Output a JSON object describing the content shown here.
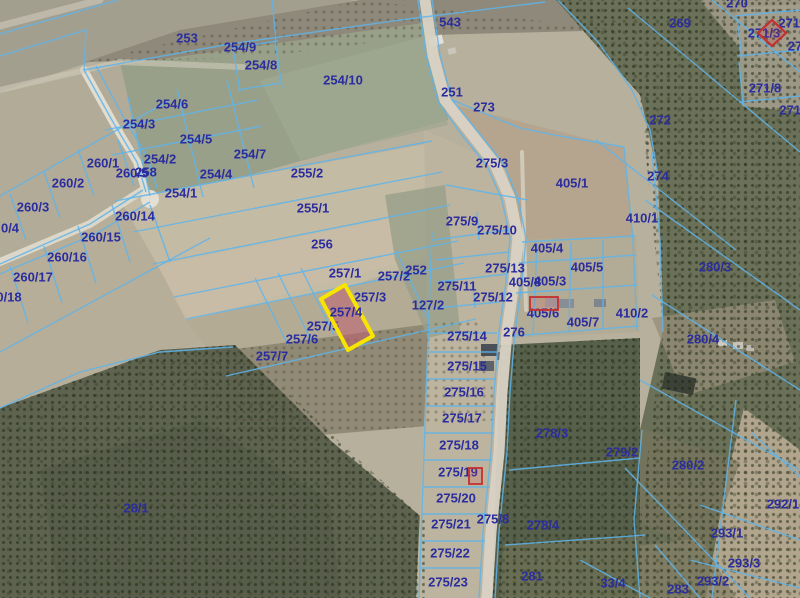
{
  "map": {
    "colors": {
      "boundary_line": "#5fb4ea",
      "label_text": "#2b2d9e",
      "highlight_stroke": "#f7e400",
      "highlight_fill": "rgba(190,95,110,0.55)",
      "marker_red": "#c43030",
      "road_light": "#d9d3c5"
    },
    "highlight": {
      "parcel": "257/4",
      "points": "321,299 345,285 373,336 348,350",
      "stroke_width": 4
    },
    "markers": [
      {
        "type": "diamond",
        "points": "772,20 786,33 772,46 758,33"
      },
      {
        "type": "rect",
        "x": 530,
        "y": 297,
        "w": 28,
        "h": 13
      },
      {
        "type": "rect",
        "x": 469,
        "y": 468,
        "w": 13,
        "h": 16
      }
    ],
    "labels": [
      {
        "t": "253",
        "x": 187,
        "y": 38
      },
      {
        "t": "254/9",
        "x": 240,
        "y": 47
      },
      {
        "t": "254/8",
        "x": 261,
        "y": 65
      },
      {
        "t": "254/10",
        "x": 343,
        "y": 80
      },
      {
        "t": "543",
        "x": 450,
        "y": 22
      },
      {
        "t": "251",
        "x": 452,
        "y": 92
      },
      {
        "t": "273",
        "x": 484,
        "y": 107
      },
      {
        "t": "270",
        "x": 737,
        "y": 3
      },
      {
        "t": "269",
        "x": 680,
        "y": 23
      },
      {
        "t": "271/",
        "x": 791,
        "y": 23
      },
      {
        "t": "271/3",
        "x": 764,
        "y": 33
      },
      {
        "t": "27",
        "x": 795,
        "y": 46
      },
      {
        "t": "271/8",
        "x": 765,
        "y": 88
      },
      {
        "t": "271/",
        "x": 792,
        "y": 110
      },
      {
        "t": "272",
        "x": 660,
        "y": 120
      },
      {
        "t": "274",
        "x": 658,
        "y": 176
      },
      {
        "t": "254/6",
        "x": 172,
        "y": 104
      },
      {
        "t": "254/3",
        "x": 139,
        "y": 124
      },
      {
        "t": "254/5",
        "x": 196,
        "y": 139
      },
      {
        "t": "254/7",
        "x": 250,
        "y": 154
      },
      {
        "t": "254/2",
        "x": 160,
        "y": 159
      },
      {
        "t": "260/1",
        "x": 103,
        "y": 163
      },
      {
        "t": "260/5",
        "x": 132,
        "y": 173
      },
      {
        "t": "258",
        "x": 146,
        "y": 172
      },
      {
        "t": "254/4",
        "x": 216,
        "y": 174
      },
      {
        "t": "255/2",
        "x": 307,
        "y": 173
      },
      {
        "t": "254/1",
        "x": 181,
        "y": 193
      },
      {
        "t": "260/2",
        "x": 68,
        "y": 183
      },
      {
        "t": "260/3",
        "x": 33,
        "y": 207
      },
      {
        "t": "0/4",
        "x": 10,
        "y": 228
      },
      {
        "t": "260/14",
        "x": 135,
        "y": 216
      },
      {
        "t": "260/15",
        "x": 101,
        "y": 237
      },
      {
        "t": "260/16",
        "x": 67,
        "y": 257
      },
      {
        "t": "260/17",
        "x": 33,
        "y": 277
      },
      {
        "t": "0/18",
        "x": 9,
        "y": 297
      },
      {
        "t": "275/3",
        "x": 492,
        "y": 163
      },
      {
        "t": "405/1",
        "x": 572,
        "y": 183
      },
      {
        "t": "410/1",
        "x": 642,
        "y": 218
      },
      {
        "t": "275/9",
        "x": 462,
        "y": 221
      },
      {
        "t": "275/10",
        "x": 497,
        "y": 230
      },
      {
        "t": "405/4",
        "x": 547,
        "y": 248
      },
      {
        "t": "255/1",
        "x": 313,
        "y": 208
      },
      {
        "t": "256",
        "x": 322,
        "y": 244
      },
      {
        "t": "252",
        "x": 416,
        "y": 270
      },
      {
        "t": "257/1",
        "x": 345,
        "y": 273
      },
      {
        "t": "257/2",
        "x": 394,
        "y": 276
      },
      {
        "t": "275/13",
        "x": 505,
        "y": 268
      },
      {
        "t": "405/5",
        "x": 587,
        "y": 267
      },
      {
        "t": "275/11",
        "x": 457,
        "y": 286
      },
      {
        "t": "405/8",
        "x": 525,
        "y": 282
      },
      {
        "t": "405/3",
        "x": 550,
        "y": 281
      },
      {
        "t": "257/3",
        "x": 370,
        "y": 297
      },
      {
        "t": "275/12",
        "x": 493,
        "y": 297
      },
      {
        "t": "127/2",
        "x": 428,
        "y": 305
      },
      {
        "t": "257/4",
        "x": 346,
        "y": 312,
        "top": true
      },
      {
        "t": "405/6",
        "x": 543,
        "y": 313
      },
      {
        "t": "405/7",
        "x": 583,
        "y": 322
      },
      {
        "t": "410/2",
        "x": 632,
        "y": 313
      },
      {
        "t": "280/3",
        "x": 715,
        "y": 267
      },
      {
        "t": "257/5",
        "x": 323,
        "y": 326
      },
      {
        "t": "276",
        "x": 514,
        "y": 332
      },
      {
        "t": "275/14",
        "x": 467,
        "y": 336
      },
      {
        "t": "257/6",
        "x": 302,
        "y": 339
      },
      {
        "t": "280/4",
        "x": 703,
        "y": 339
      },
      {
        "t": "257/7",
        "x": 272,
        "y": 356
      },
      {
        "t": "275/15",
        "x": 467,
        "y": 366
      },
      {
        "t": "275/16",
        "x": 464,
        "y": 392
      },
      {
        "t": "275/17",
        "x": 462,
        "y": 418
      },
      {
        "t": "278/3",
        "x": 552,
        "y": 433
      },
      {
        "t": "275/18",
        "x": 459,
        "y": 445
      },
      {
        "t": "279/2",
        "x": 622,
        "y": 452
      },
      {
        "t": "280/2",
        "x": 688,
        "y": 465
      },
      {
        "t": "275/19",
        "x": 458,
        "y": 472
      },
      {
        "t": "275/20",
        "x": 456,
        "y": 498
      },
      {
        "t": "28/1",
        "x": 136,
        "y": 508
      },
      {
        "t": "292/1",
        "x": 783,
        "y": 504
      },
      {
        "t": "275/21",
        "x": 451,
        "y": 524
      },
      {
        "t": "275/8",
        "x": 493,
        "y": 519
      },
      {
        "t": "278/4",
        "x": 543,
        "y": 525
      },
      {
        "t": "293/1",
        "x": 727,
        "y": 533
      },
      {
        "t": "275/22",
        "x": 450,
        "y": 553
      },
      {
        "t": "293/3",
        "x": 744,
        "y": 563
      },
      {
        "t": "281",
        "x": 532,
        "y": 576
      },
      {
        "t": "275/23",
        "x": 448,
        "y": 582
      },
      {
        "t": "33/4",
        "x": 613,
        "y": 583
      },
      {
        "t": "283",
        "x": 678,
        "y": 589
      },
      {
        "t": "293/2",
        "x": 713,
        "y": 581
      }
    ],
    "roads": [
      {
        "d": "M425,0 L433,55 L445,100 L470,132 L495,164 L510,198 L518,238 L514,282 L507,332 L502,392 L499,452 L491,532 L487,598",
        "w": 11,
        "c": "#d9d3c5",
        "o": 0.95
      },
      {
        "d": "M84,70 L113,122 L137,162 L146,192",
        "w": 8,
        "c": "#e4dfd3",
        "o": 0.95
      },
      {
        "d": "M143,190 L90,224 L0,262",
        "w": 8,
        "c": "#e0dbcd",
        "o": 0.9
      },
      {
        "d": "M0,90 L120,62 L243,67",
        "w": 6,
        "c": "#cfc9ba",
        "o": 0.6
      },
      {
        "d": "M0,26 L100,0",
        "w": 7,
        "c": "#c8c3b5",
        "o": 0.7
      },
      {
        "d": "M522,152 L526,310",
        "w": 4,
        "c": "#ddd8ca",
        "o": 0.7
      }
    ],
    "road_bulb": {
      "cx": 150,
      "cy": 199,
      "r": 9,
      "c": "#e4dfd3"
    },
    "boundaries": [
      "M0,34 L118,0",
      "M0,56 L86,30 L84,70",
      "M84,70 L230,44 L400,20 L545,2",
      "M432,0 L440,55 L452,100 L478,132 L503,163 L518,198 L526,238 L522,282 L515,332 L510,392 L507,452 L499,532 L495,598",
      "M418,0 L426,55 L438,102 L462,135 L487,166 L502,200 L510,238 L506,282 L499,332 L494,392 L491,452 L483,532 L479,598",
      "M452,100 L520,128 L560,136 L624,147",
      "M624,147 L633,240 L637,330",
      "M652,152 L660,240 L663,332",
      "M522,242 L635,236",
      "M519,263 L636,255",
      "M516,293 L637,285",
      "M513,336 L638,326",
      "M537,244 L533,334",
      "M571,242 L569,332",
      "M603,240 L603,330",
      "M434,240 L508,230",
      "M436,260 L509,252",
      "M438,282 L507,274",
      "M436,308 L500,302",
      "M428,333 L497,333",
      "M477,212 L479,240",
      "M473,284 L475,308",
      "M432,232 L428,338",
      "M446,185 L528,200",
      "M428,338 L419,598",
      "M427,352 L497,352",
      "M426,379 L496,379",
      "M425,406 L495,406",
      "M424,433 L494,433",
      "M424,460 L492,460",
      "M423,487 L490,487",
      "M422,514 L488,514",
      "M421,541 L485,541",
      "M420,568 L482,568",
      "M115,201 L432,141",
      "M133,232 L442,172",
      "M153,264 L450,205",
      "M174,297 L458,241",
      "M186,319 L464,263",
      "M226,376 L476,319",
      "M255,278 L288,345",
      "M278,273 L311,340",
      "M301,268 L334,335",
      "M396,251 L428,318",
      "M105,130 L258,100",
      "M112,155 L262,126",
      "M128,97 L150,196",
      "M177,89 L203,197",
      "M227,80 L254,188",
      "M233,48 L240,92",
      "M231,48 L278,41",
      "M275,40 L282,88",
      "M238,90 L280,83",
      "M276,40 L272,0",
      "M84,70 L113,122 L137,162 L146,192",
      "M96,66 L124,118 L148,158 L157,188",
      "M143,190 L90,224 L0,264",
      "M150,202 L95,234 L0,274",
      "M0,196 L170,100",
      "M0,352 L210,238",
      "M118,140 L134,186",
      "M78,150 L94,196",
      "M44,172 L60,218",
      "M10,194 L26,240",
      "M112,205 L130,262",
      "M78,226 L96,283",
      "M44,246 L62,303",
      "M10,266 L28,323",
      "M150,205 L170,262",
      "M558,0 L598,42 L632,90 L650,130 L658,175",
      "M628,8 L800,152",
      "M712,0 L800,72",
      "M596,140 L736,250",
      "M735,16 L800,10",
      "M737,18 L742,58",
      "M737,56 L800,50",
      "M739,62 L743,104",
      "M739,102 L800,96",
      "M645,200 L800,310",
      "M652,295 L800,390",
      "M640,380 L800,470",
      "M625,468 L750,598",
      "M752,433 L800,477",
      "M736,400 L712,598",
      "M700,505 L800,540",
      "M690,560 L800,588",
      "M655,545 L700,598",
      "M580,560 L650,598",
      "M509,470 L640,458",
      "M505,545 L645,535",
      "M642,430 L634,520 L640,598",
      "M0,408 L80,372 L160,352 L233,347"
    ],
    "buildings": [
      {
        "x": 430,
        "y": 36,
        "w": 13,
        "h": 9,
        "f": "#e2e0da",
        "r": -15
      },
      {
        "x": 448,
        "y": 48,
        "w": 8,
        "h": 6,
        "f": "#c9c6bc",
        "r": -15
      },
      {
        "x": 481,
        "y": 344,
        "w": 17,
        "h": 12,
        "f": "#4a5058",
        "r": 0
      },
      {
        "x": 479,
        "y": 361,
        "w": 15,
        "h": 10,
        "f": "#5c636b",
        "r": 0
      },
      {
        "x": 497,
        "y": 352,
        "w": 10,
        "h": 8,
        "f": "#6a7178",
        "r": 0
      },
      {
        "x": 545,
        "y": 298,
        "w": 12,
        "h": 9,
        "f": "#9aa0a6",
        "r": 0
      },
      {
        "x": 559,
        "y": 299,
        "w": 15,
        "h": 9,
        "f": "#888e96",
        "r": 0
      },
      {
        "x": 594,
        "y": 299,
        "w": 12,
        "h": 8,
        "f": "#7e858c",
        "r": 0
      },
      {
        "x": 663,
        "y": 375,
        "w": 32,
        "h": 17,
        "f": "#3c4237",
        "r": 12
      },
      {
        "x": 718,
        "y": 340,
        "w": 9,
        "h": 6,
        "f": "#cfcbc0",
        "r": 0
      },
      {
        "x": 733,
        "y": 342,
        "w": 10,
        "h": 7,
        "f": "#c7c3b8",
        "r": 0
      },
      {
        "x": 746,
        "y": 345,
        "w": 8,
        "h": 6,
        "f": "#bdb9ae",
        "r": 0
      }
    ]
  }
}
